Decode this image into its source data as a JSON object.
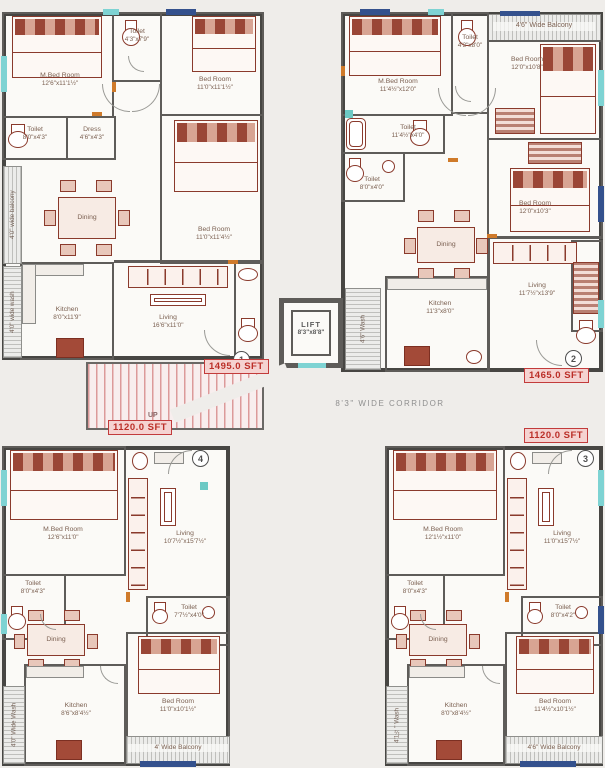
{
  "colors": {
    "outer_wall": "#474643",
    "inner_wall": "#5e5c59",
    "furniture": "#8a3a2c",
    "window_teal": "#7ed3d3",
    "window_blue": "#34518d",
    "door_orange": "#cf7a2a",
    "stairs_pink": "#dc9a9a",
    "area_label_red": "#bb2f28"
  },
  "core": {
    "lift_name": "LIFT",
    "lift_dims": "8'3\"x8'8\"",
    "corridor": "8'3\" WIDE CORRIDOR",
    "stairs_up": "UP",
    "wash_center": "4'6\" Wash"
  },
  "flat1": {
    "number": "1",
    "area": "1495.0 SFT",
    "balcony": "4'0\" wide balcony",
    "wash": "4'0\" wide wash",
    "mbed_name": "M.Bed Room",
    "mbed_dims": "12'6\"x11'1½\"",
    "toilet_top_name": "Toilet",
    "toilet_top_dims": "4'3\"x7'9\"",
    "bed1_name": "Bed Room",
    "bed1_dims": "11'0\"x11'1½\"",
    "toilet_left_name": "Toilet",
    "toilet_left_dims": "8'0\"x4'3\"",
    "dress_name": "Dress",
    "dress_dims": "4'6\"x4'3\"",
    "bed2_name": "Bed Room",
    "bed2_dims": "11'0\"x11'4½\"",
    "dining": "Dining",
    "kitchen_name": "Kitchen",
    "kitchen_dims": "8'0\"x11'9\"",
    "living_name": "Living",
    "living_dims": "16'6\"x11'0\""
  },
  "flat2": {
    "number": "2",
    "area": "1465.0 SFT",
    "balcony": "4'6\" Wide Balcony",
    "mbed_name": "M.Bed Room",
    "mbed_dims": "11'4½\"x12'0\"",
    "toilet_top_name": "Toilet",
    "toilet_top_dims": "4'3\"x8'0\"",
    "bed1_name": "Bed Room",
    "bed1_dims": "12'0\"x10'8\"",
    "toilet_mid1_name": "Toilet",
    "toilet_mid1_dims": "11'4½\"x4'0\"",
    "toilet_mid2_name": "Toilet",
    "toilet_mid2_dims": "8'0\"x4'0\"",
    "bed2_name": "Bed Room",
    "bed2_dims": "12'0\"x10'3\"",
    "dining": "Dining",
    "kitchen_name": "Kitchen",
    "kitchen_dims": "11'3\"x8'0\"",
    "living_name": "Living",
    "living_dims": "11'7½\"x13'9\""
  },
  "flat3": {
    "number": "3",
    "area": "1120.0 SFT",
    "balcony": "4'6\" Wide Balcony",
    "wash": "4'1½\" Wash",
    "mbed_name": "M.Bed Room",
    "mbed_dims": "12'1½\"x11'0\"",
    "toilet_left_name": "Toilet",
    "toilet_left_dims": "8'0\"x4'3\"",
    "toilet_mid_name": "Toilet",
    "toilet_mid_dims": "8'0\"x4'2\"",
    "bed_name": "Bed Room",
    "bed_dims": "11'4½\"x10'1½\"",
    "dining": "Dining",
    "kitchen_name": "Kitchen",
    "kitchen_dims": "8'0\"x8'4½\"",
    "living_name": "Living",
    "living_dims": "11'0\"x15'7½\""
  },
  "flat4": {
    "number": "4",
    "area": "1120.0 SFT",
    "balcony": "4' Wide Balcony",
    "wash": "4'0\" Wide Wash",
    "mbed_name": "M.Bed Room",
    "mbed_dims": "12'6\"x11'0\"",
    "toilet_left_name": "Toilet",
    "toilet_left_dims": "8'0\"x4'3\"",
    "toilet_mid_name": "Toilet",
    "toilet_mid_dims": "7'7½\"x4'0\"",
    "bed_name": "Bed Room",
    "bed_dims": "11'0\"x10'1½\"",
    "dining": "Dining",
    "kitchen_name": "Kitchen",
    "kitchen_dims": "8'6\"x8'4½\"",
    "living_name": "Living",
    "living_dims": "10'7½\"x15'7½\""
  }
}
